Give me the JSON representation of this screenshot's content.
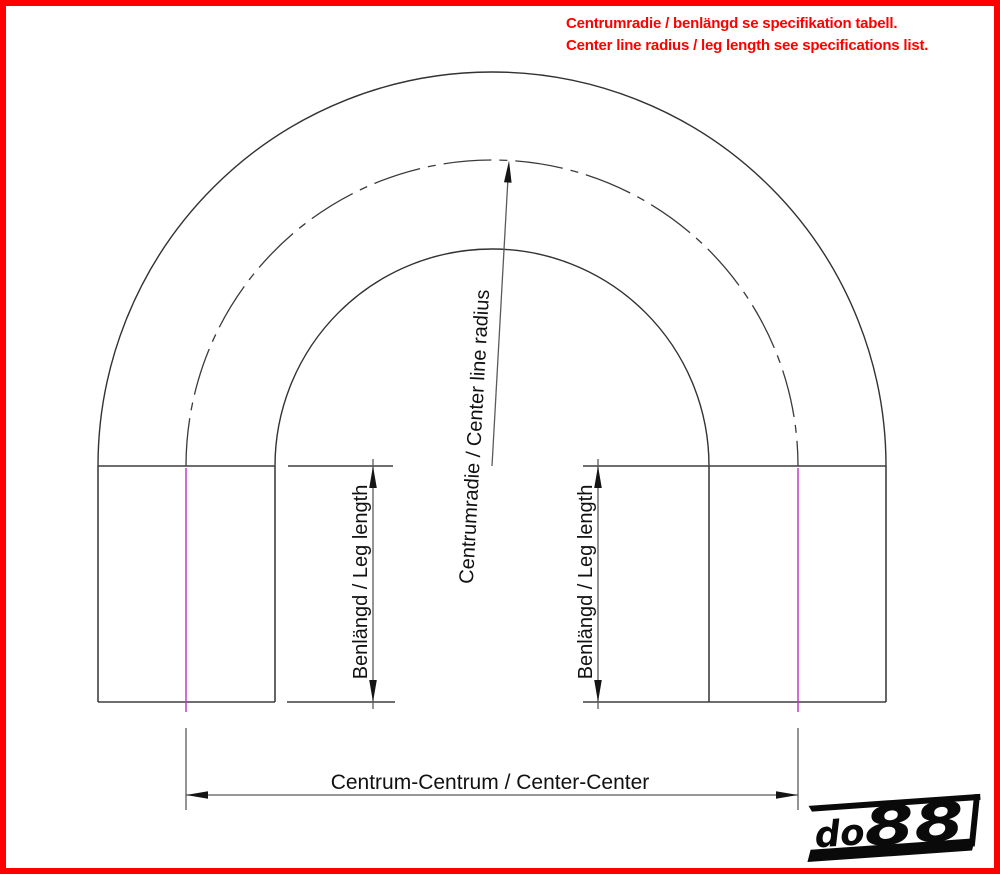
{
  "note": {
    "line1": "Centrumradie / benlängd se specifikation tabell.",
    "line2": "Center line radius / leg length see specifications list."
  },
  "labels": {
    "center_line_radius": "Centrumradie / Center line radius",
    "leg_length": "Benlängd / Leg length",
    "center_center": "Centrum-Centrum / Center-Center"
  },
  "logo": {
    "do": "do",
    "digits": "88"
  },
  "colors": {
    "note_red": "#ff0000",
    "border_red": "#ff0000",
    "centerline_magenta": "#c23cc8",
    "drawing_line": "#3f3f3f"
  }
}
